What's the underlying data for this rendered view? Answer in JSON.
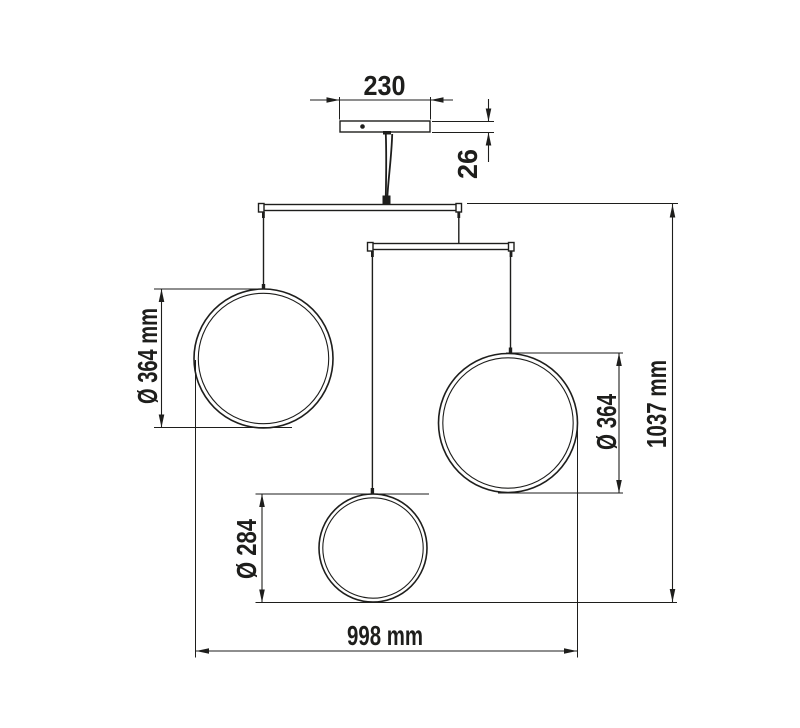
{
  "page": {
    "background_color": "#ffffff"
  },
  "drawing": {
    "line_color": "#1e1e1c",
    "labels": {
      "canopy_width": "230",
      "canopy_height": "26",
      "left_ring_diameter": "Ø 364 mm",
      "right_ring_diameter": "Ø 364",
      "bottom_ring_diameter": "Ø 284",
      "overall_height": "1037 mm",
      "overall_width": "998 mm"
    }
  }
}
